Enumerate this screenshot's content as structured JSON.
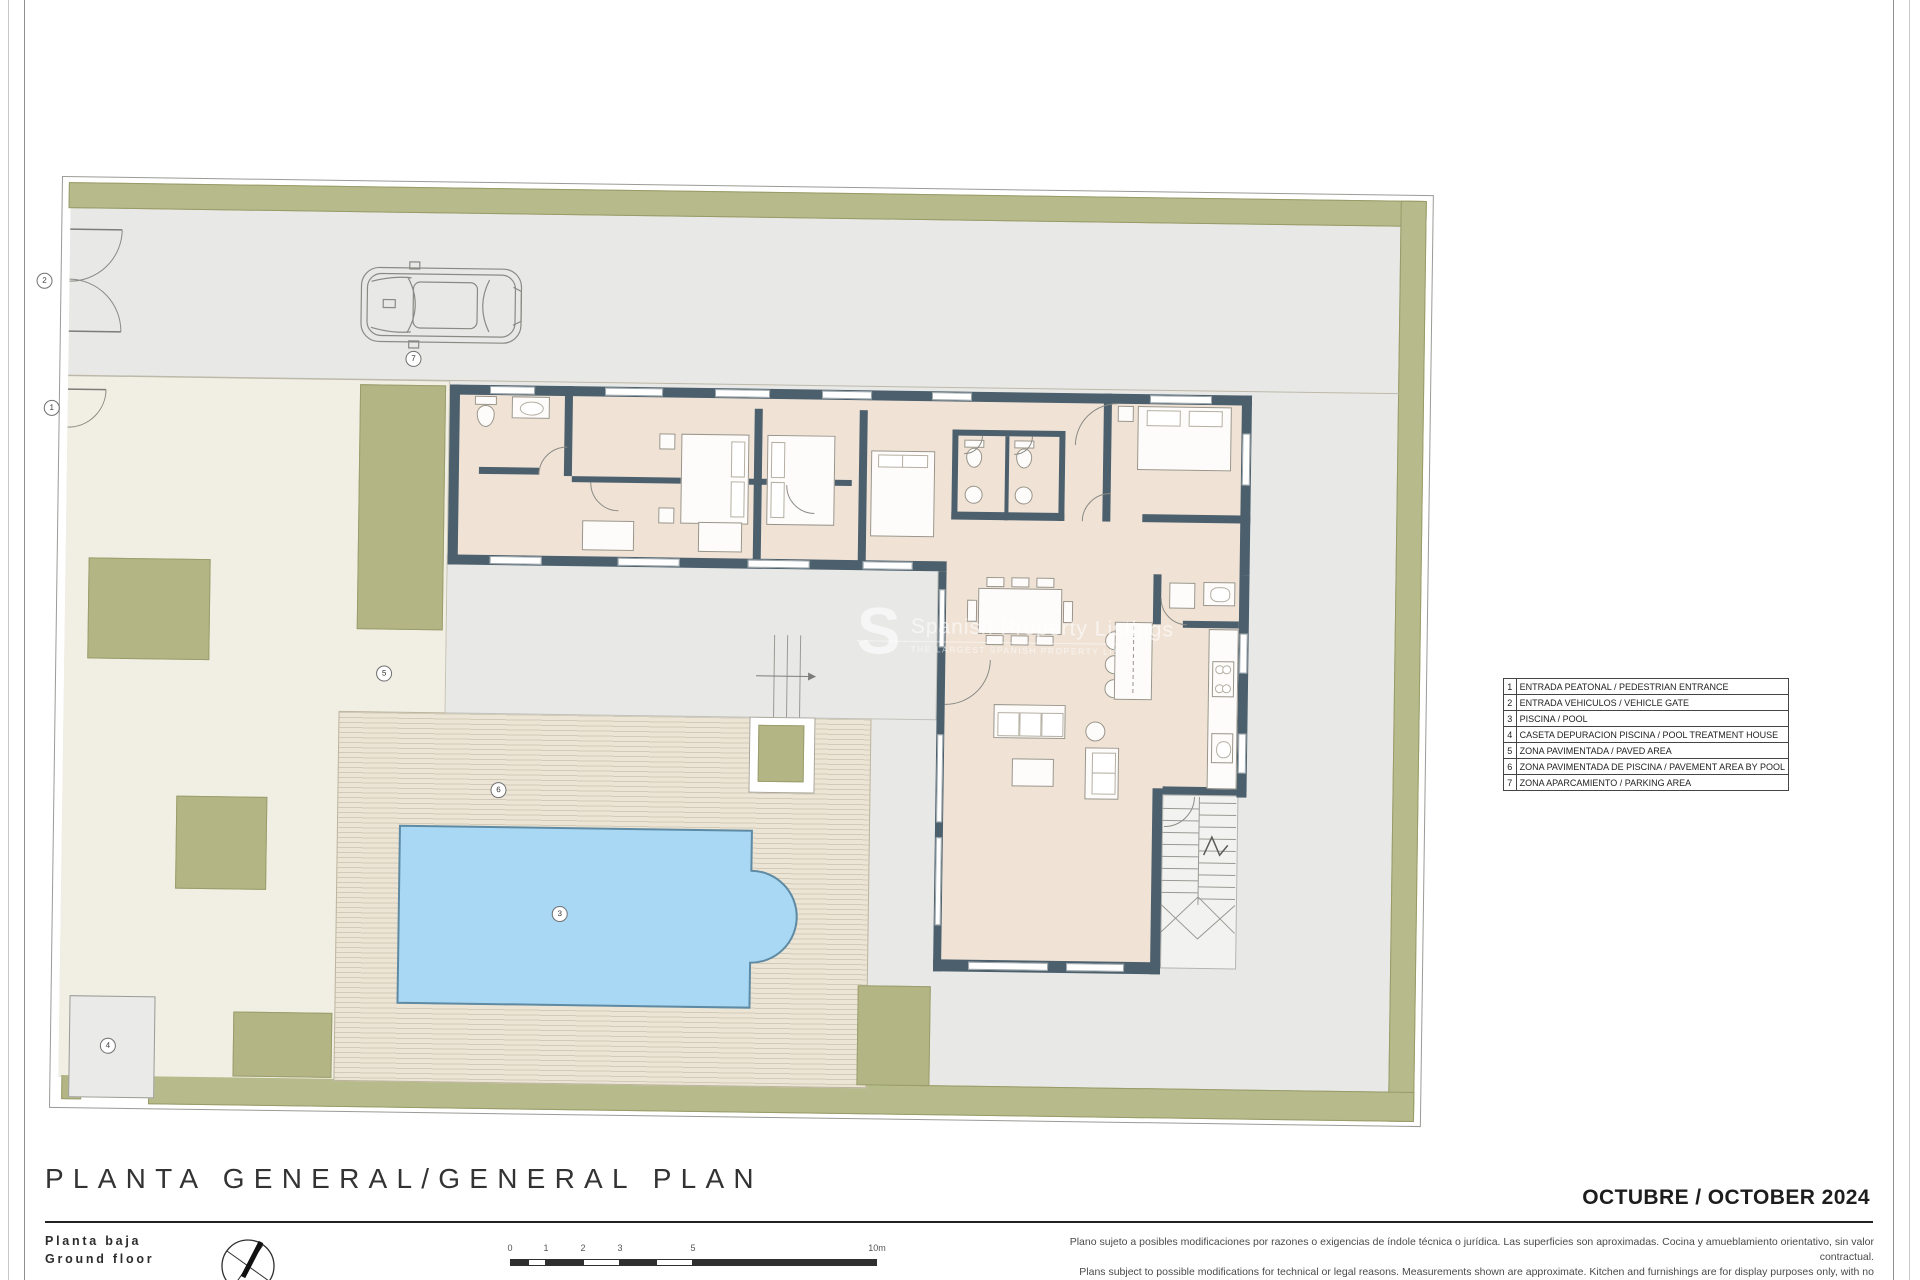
{
  "sheet": {
    "title": "PLANTA GENERAL/GENERAL PLAN",
    "subtitle_line1": "Planta baja",
    "subtitle_line2": "Ground floor",
    "date": "OCTUBRE / OCTOBER 2024",
    "disclaimer_es": "Plano sujeto a posibles modificaciones por razones o exigencias de índole técnica o jurídica. Las superficies son aproximadas. Cocina y amueblamiento orientativo, sin valor contractual.",
    "disclaimer_en": "Plans subject to possible modifications for technical or legal reasons. Measurements shown are approximate. Kitchen and furnishings are for display purposes only, with no contractual value."
  },
  "legend": {
    "rows": [
      {
        "num": "1",
        "label": "ENTRADA PEATONAL / PEDESTRIAN ENTRANCE"
      },
      {
        "num": "2",
        "label": "ENTRADA VEHICULOS / VEHICLE GATE"
      },
      {
        "num": "3",
        "label": "PISCINA / POOL"
      },
      {
        "num": "4",
        "label": "CASETA DEPURACION PISCINA / POOL TREATMENT HOUSE"
      },
      {
        "num": "5",
        "label": "ZONA PAVIMENTADA / PAVED AREA"
      },
      {
        "num": "6",
        "label": "ZONA PAVIMENTADA DE PISCINA / PAVEMENT AREA BY POOL"
      },
      {
        "num": "7",
        "label": "ZONA APARCAMIENTO / PARKING AREA"
      }
    ]
  },
  "markers": [
    {
      "num": "1"
    },
    {
      "num": "2"
    },
    {
      "num": "3"
    },
    {
      "num": "4"
    },
    {
      "num": "5"
    },
    {
      "num": "6"
    },
    {
      "num": "7"
    }
  ],
  "scale_bar": {
    "labels": [
      "0",
      "1",
      "2",
      "3",
      "5",
      "10m"
    ]
  },
  "watermark": {
    "initial": "S",
    "line1": "Spanish Property Listings",
    "line2": "THE LARGEST SPANISH PROPERTY LISTING"
  },
  "colors": {
    "wall": "#4b5f6c",
    "room_floor": "#f0e3d6",
    "hedge": "#b7ba8b",
    "pool": "#a8d8f4",
    "deck": "#ece5d5",
    "paved_gray": "#e8e8e6",
    "garden_cream": "#f1eee3"
  }
}
